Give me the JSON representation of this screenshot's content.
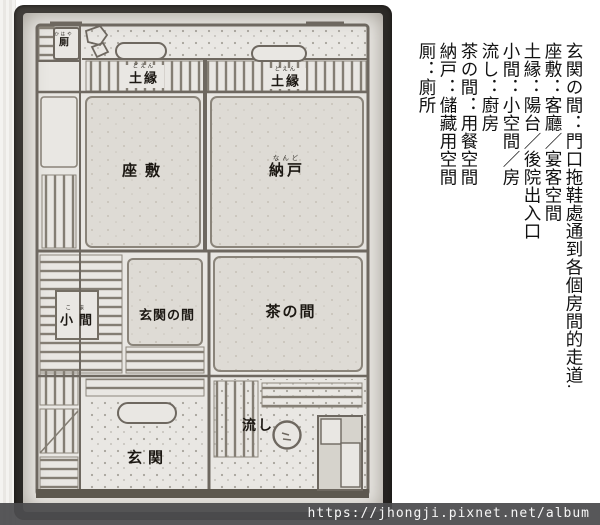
{
  "floorplan": {
    "rooms": [
      {
        "name": "厠",
        "furigana": "かはや"
      },
      {
        "name": "土縁",
        "furigana": "どえん"
      },
      {
        "name": "土縁",
        "furigana": "どえん"
      },
      {
        "name": "座敷"
      },
      {
        "name": "納戸",
        "furigana": "なんど"
      },
      {
        "name": "小間",
        "furigana": "こま"
      },
      {
        "name": "玄関の間"
      },
      {
        "name": "茶の間"
      },
      {
        "name": "玄関"
      },
      {
        "name": "流し"
      }
    ]
  },
  "legend": {
    "columns": [
      "玄関の間：門口拖鞋處通到各個房間的走道.",
      "座敷：客廳／宴客空間",
      "土縁：陽台／後院出入口",
      "小間：小空間／房",
      "流し：廚房",
      "茶の間：用餐空間",
      "納戸：儲藏用空間",
      "厠：廁所"
    ]
  },
  "watermark": {
    "url_text": "https://jhongji.pixnet.net/album"
  }
}
